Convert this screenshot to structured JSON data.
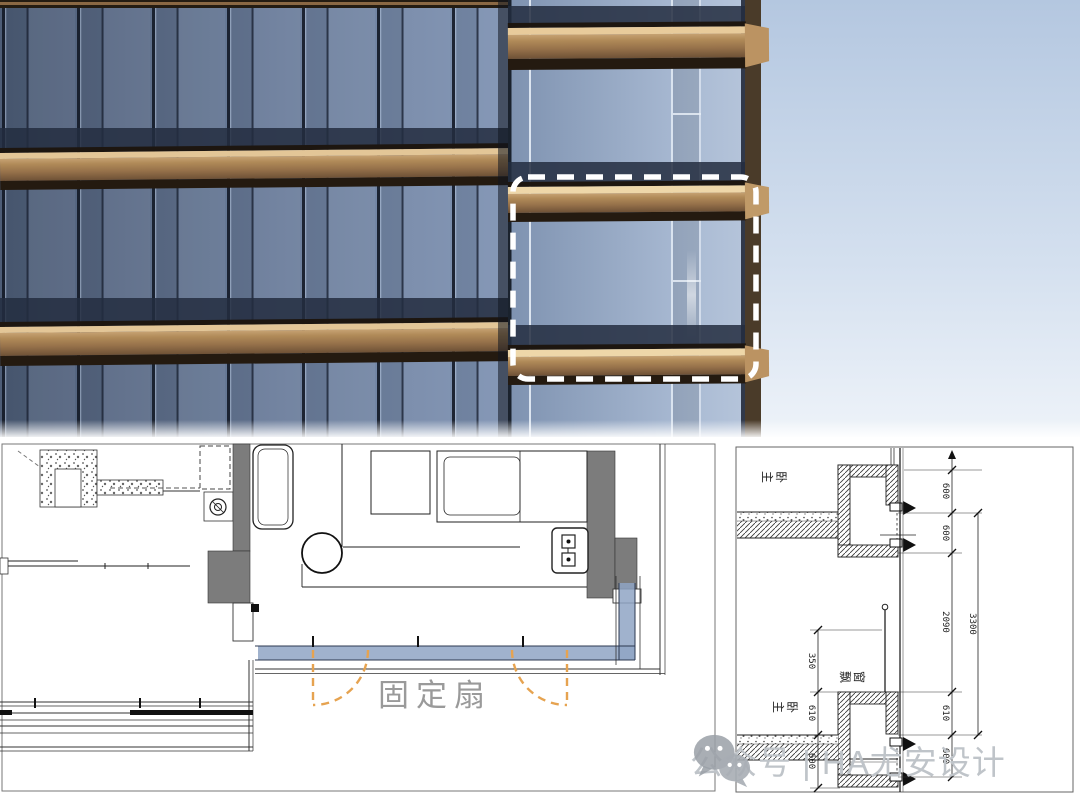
{
  "colors": {
    "sky_top": "#b4c7e0",
    "sky_bottom": "#eef3f9",
    "glass_dark": "#4e5d77",
    "glass_light": "#8195b5",
    "bronze_band": "#a07c52",
    "bronze_lip": "#e3c697",
    "highlight_dash": "#ffffff",
    "window_blue": "#8fa5c4",
    "sash_orange": "#e6a350",
    "wall_gray": "#7c7c7c",
    "label_gray": "#9a9a9a",
    "watermark_gray": "#bfc4c9"
  },
  "plan": {
    "fixed_sash_label": "固定扇"
  },
  "section": {
    "room_label_upper": "主卧",
    "room_label_lower": "主卧",
    "bay_window_label": "飘窗",
    "dims_right": [
      "600",
      "600",
      "2090",
      "610",
      "600"
    ],
    "dim_overall": "3300",
    "dims_left": [
      "350",
      "610",
      "600"
    ]
  },
  "watermark": {
    "text": "公众号 | HA尤安设计"
  }
}
